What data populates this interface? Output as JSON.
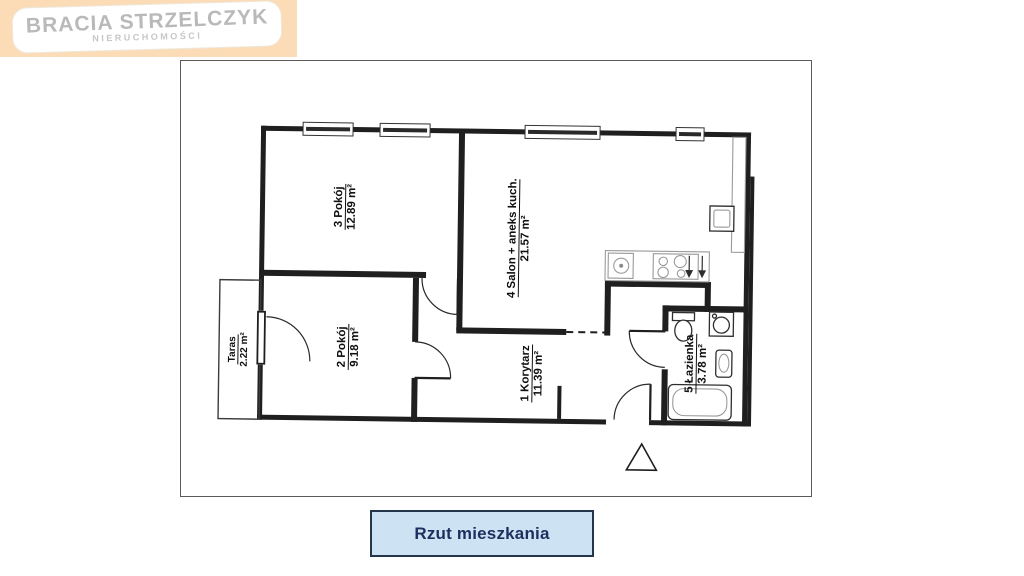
{
  "logo": {
    "line1": "BRACIA STRZELCZYK",
    "line2": "NIERUCHOMOŚCI"
  },
  "plan": {
    "rooms": [
      {
        "name": "3 Pokój",
        "area": "12.89 m²"
      },
      {
        "name": "4 Salon + aneks kuch.",
        "area": "21.57 m²"
      },
      {
        "name": "2 Pokój",
        "area": "9.18 m²"
      },
      {
        "name": "1 Korytarz",
        "area": "11.39 m²"
      },
      {
        "name": "5 Łazienka",
        "area": "3.78 m²"
      },
      {
        "name": "Taras",
        "area": "2.22 m²"
      }
    ]
  },
  "caption": {
    "label": "Rzut mieszkania"
  },
  "colors": {
    "logo_background": "#fbdcb6",
    "logo_text": "#b9b9b9",
    "caption_background": "#cde3f3",
    "caption_border": "#24374a",
    "caption_text": "#1d2e5f",
    "plan_line": "#1f1f1f"
  }
}
